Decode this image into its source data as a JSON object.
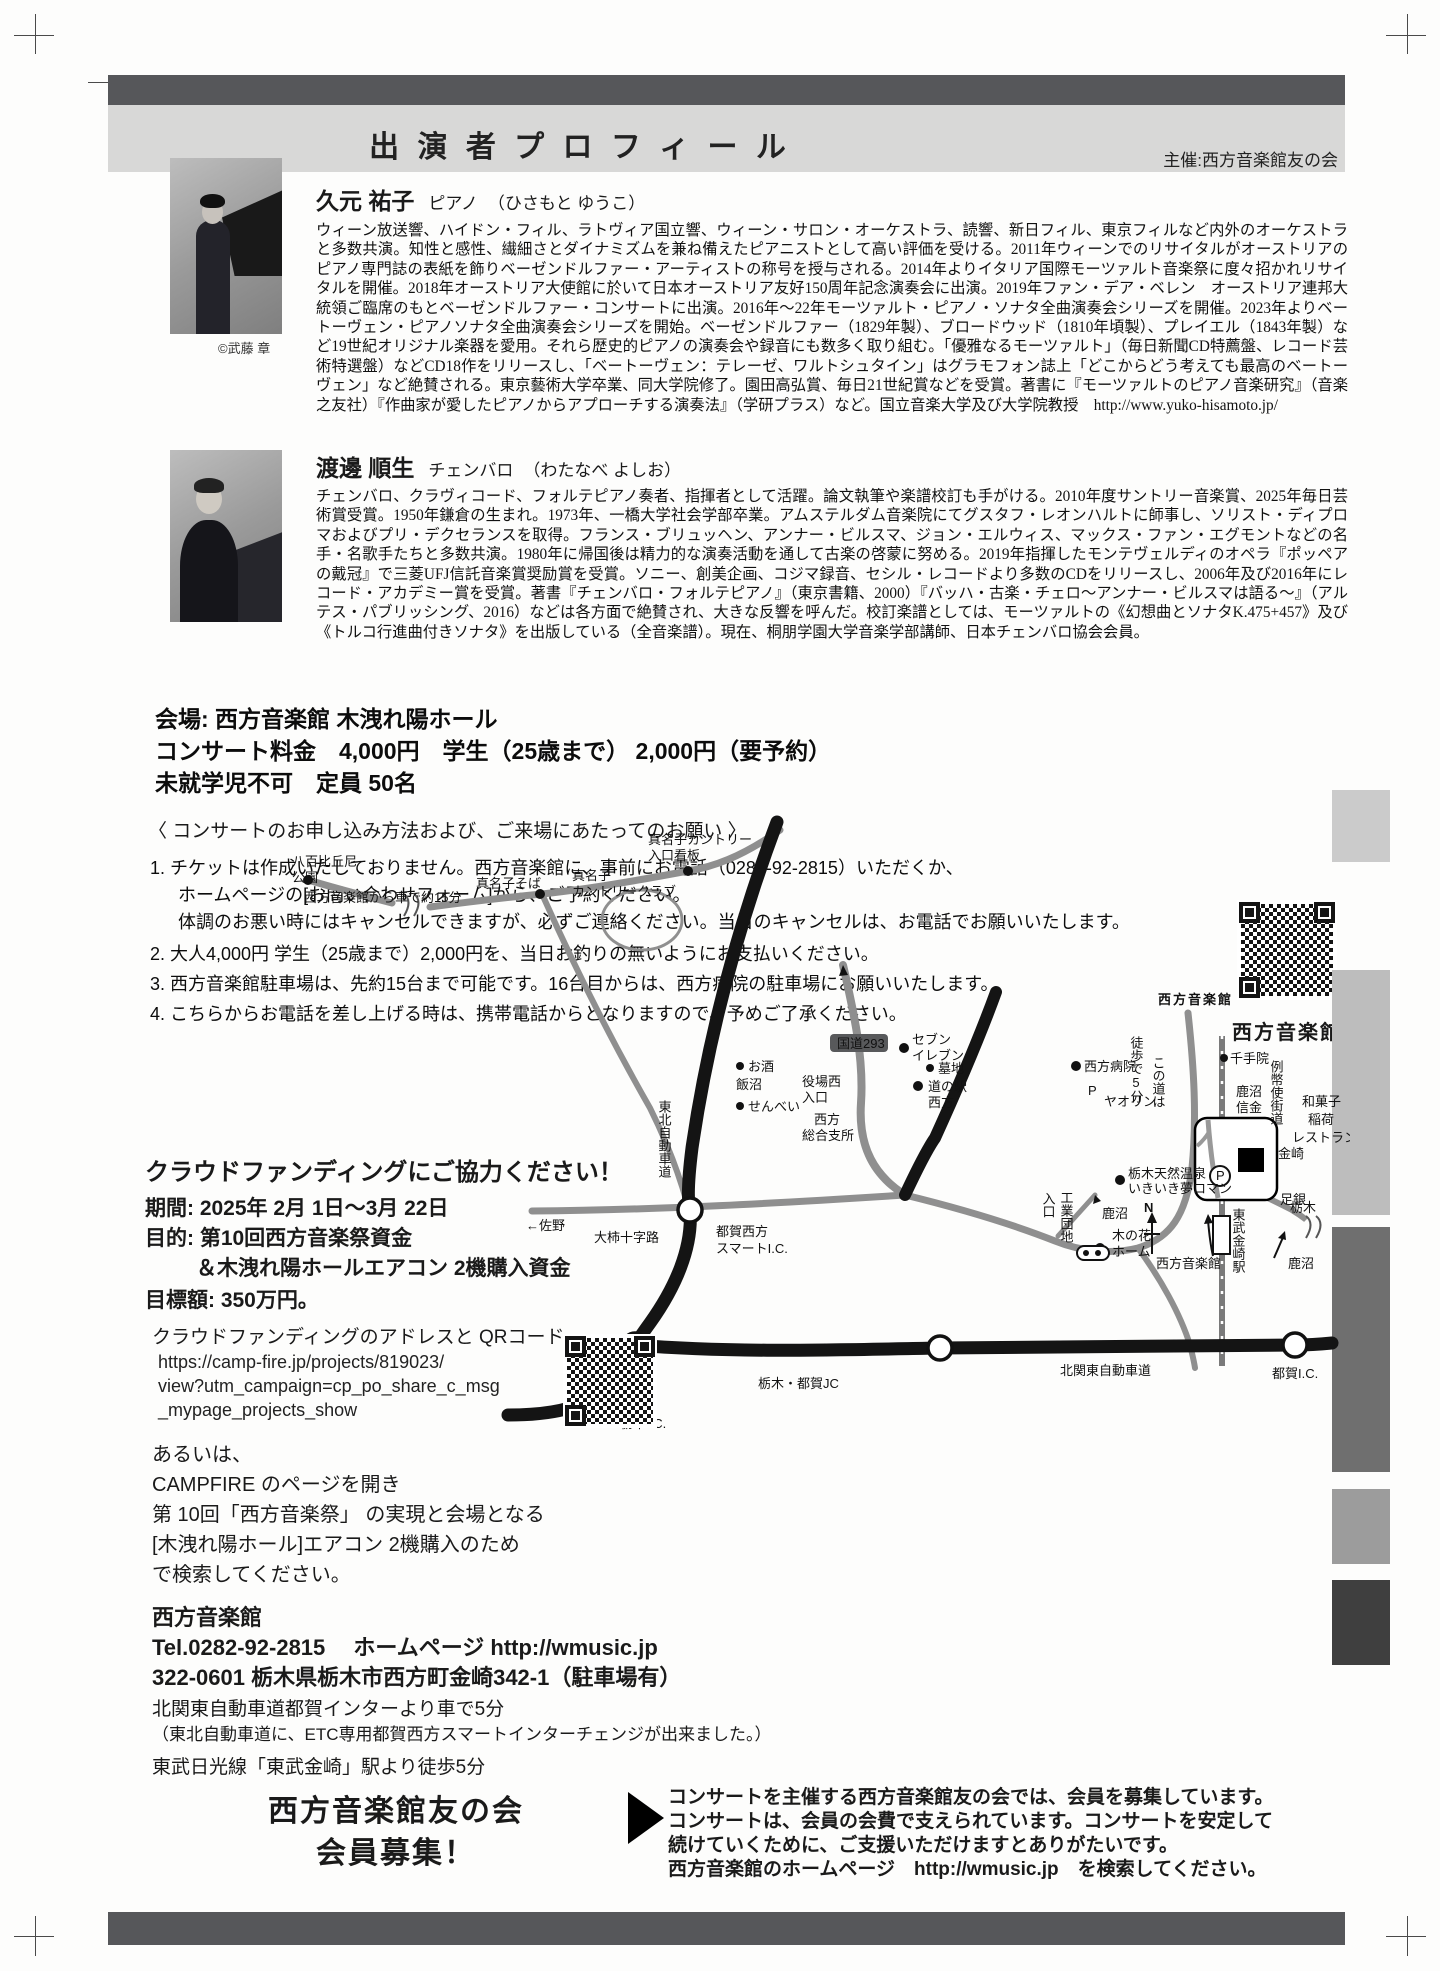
{
  "colors": {
    "header_bar": "#56575a",
    "header_panel": "#d8d8d7",
    "road_black": "#141414",
    "road_gray": "#8f8f8f"
  },
  "header": {
    "title": "出 演 者 プ ロ フ ィ ー ル",
    "organizer": "主催:西方音楽館友の会"
  },
  "performers": [
    {
      "name": "久元 祐子",
      "role": "ピアノ",
      "reading": "（ひさもと ゆうこ）",
      "photo_credit": "©武藤 章",
      "bio": "ウィーン放送響、ハイドン・フィル、ラトヴィア国立響、ウィーン・サロン・オーケストラ、読響、新日フィル、東京フィルなど内外のオーケストラと多数共演。知性と感性、繊細さとダイナミズムを兼ね備えたピアニストとして高い評価を受ける。2011年ウィーンでのリサイタルがオーストリアのピアノ専門誌の表紙を飾りベーゼンドルファー・アーティストの称号を授与される。2014年よりイタリア国際モーツァルト音楽祭に度々招かれリサイタルを開催。2018年オーストリア大使館に於いて日本オーストリア友好150周年記念演奏会に出演。2019年ファン・デア・ベレン　オーストリア連邦大統領ご臨席のもとベーゼンドルファー・コンサートに出演。2016年〜22年モーツァルト・ピアノ・ソナタ全曲演奏会シリーズを開催。2023年よりベートーヴェン・ピアノソナタ全曲演奏会シリーズを開始。ベーゼンドルファー（1829年製）、ブロードウッド（1810年頃製）、プレイエル（1843年製）など19世紀オリジナル楽器を愛用。それら歴史的ピアノの演奏会や録音にも数多く取り組む。「優雅なるモーツァルト」（毎日新聞CD特薦盤、レコード芸術特選盤）などCD18作をリリースし、「ベートーヴェン：テレーゼ、ワルトシュタイン」はグラモフォン誌上「どこからどう考えても最高のベートーヴェン」など絶賛される。東京藝術大学卒業、同大学院修了。園田高弘賞、毎日21世紀賞などを受賞。著書に『モーツァルトのピアノ音楽研究』（音楽之友社）『作曲家が愛したピアノからアプローチする演奏法』（学研プラス）など。国立音楽大学及び大学院教授　http://www.yuko-hisamoto.jp/"
    },
    {
      "name": "渡邊 順生",
      "role": "チェンバロ",
      "reading": "（わたなべ よしお）",
      "bio": "チェンバロ、クラヴィコード、フォルテピアノ奏者、指揮者として活躍。論文執筆や楽譜校訂も手がける。2010年度サントリー音楽賞、2025年毎日芸術賞受賞。1950年鎌倉の生まれ。1973年、一橋大学社会学部卒業。アムステルダム音楽院にてグスタフ・レオンハルトに師事し、ソリスト・ディプロマおよびプリ・デクセランスを取得。フランス・ブリュッヘン、アンナー・ビルスマ、ジョン・エルウィス、マックス・ファン・エグモントなどの名手・名歌手たちと多数共演。1980年に帰国後は精力的な演奏活動を通して古楽の啓蒙に努める。2019年指揮したモンテヴェルディのオペラ『ポッペアの戴冠』で三菱UFJ信託音楽賞奨励賞を受賞。ソニー、創美企画、コジマ録音、セシル・レコードより多数のCDをリリースし、2006年及び2016年にレコード・アカデミー賞を受賞。著書『チェンバロ・フォルテピアノ』（東京書籍、2000）『バッハ・古楽・チェロ〜アンナー・ビルスマは語る〜』（アルテス・パブリッシング、2016）などは各方面で絶賛され、大きな反響を呼んだ。校訂楽譜としては、モーツァルトの《幻想曲とソナタK.475+457》及び《トルコ行進曲付きソナタ》を出版している（全音楽譜）。現在、桐朋学園大学音楽学部講師、日本チェンバロ協会会員。"
    }
  ],
  "venue": {
    "line1": "会場: 西方音楽館 木洩れ陽ホール",
    "line2": "コンサート料金　4,000円　学生（25歳まで） 2,000円（要予約）",
    "line3": "未就学児不可　定員 50名"
  },
  "booking": {
    "heading": "〈 コンサートのお申し込み方法および、ご来場にあたってのお願い 〉",
    "item1_l1": "1. チケットは作成いたしておりません。西方音楽館に、事前にお電話（0282-92-2815）いただくか、",
    "item1_l2": "ホームページの[お問い合わせフォーム]から、ご予約ください。",
    "item1_l3": "体調のお悪い時にはキャンセルできますが、必ずご連絡ください。当日のキャンセルは、お電話でお願いいたします。",
    "item2": "2. 大人4,000円  学生（25歳まで）2,000円を、当日お釣りの無いようにお支払いください。",
    "item3": "3. 西方音楽館駐車場は、先約15台まで可能です。16台目からは、西方病院の駐車場にお願いいたします。",
    "item4": "4. こちらからお電話を差し上げる時は、携帯電話からとなりますので、予めご了承ください。"
  },
  "qr_hall_caption": "西方音楽館",
  "crowdfunding": {
    "title": "クラウドファンディングにご協力ください！",
    "period": "期間: 2025年 2月 1日〜3月 22日",
    "purpose1": "目的: 第10回西方音楽祭資金",
    "purpose2": "＆木洩れ陽ホールエアコン 2機購入資金",
    "goal": "目標額: 350万円。",
    "address_heading": "クラウドファンディングのアドレスと QRコード",
    "url_l1": "https://camp-fire.jp/projects/819023/",
    "url_l2": "view?utm_campaign=cp_po_share_c_msg",
    "url_l3": "_mypage_projects_show",
    "alt": "あるいは、",
    "campfire_l1": "CAMPFIRE のページを開き",
    "campfire_l2": "第 10回「西方音楽祭」 の実現と会場となる",
    "campfire_l3": "[木洩れ陽ホール]エアコン 2機購入のため",
    "campfire_l4": "で検索してください。"
  },
  "contact": {
    "name": "西方音楽館",
    "tel_line": "Tel.0282-92-2815　 ホームページ  http://wmusic.jp",
    "address": "322-0601 栃木県栃木市西方町金崎342-1（駐車場有）",
    "access1": "北関東自動車道都賀インターより車で5分",
    "access2": "（東北自動車道に、ETC専用都賀西方スマートインターチェンジが出来ました。）",
    "access3": "東武日光線「東武金崎」駅より徒歩5分"
  },
  "membership": {
    "title_l1": "西方音楽館友の会",
    "title_l2": "会員募集！",
    "body_l1": "コンサートを主催する西方音楽館友の会では、会員を募集しています。",
    "body_l2": "コンサートは、会員の会費で支えられています。コンサートを安定して",
    "body_l3": "続けていくために、ご支援いただけますとありがたいです。",
    "body_l4": "西方音楽館のホームページ　http://wmusic.jp　を検索してください。"
  },
  "map": {
    "labels": [
      "真名子カントリー",
      "入口看板",
      "八百比丘尼",
      "公園",
      "西方音楽館から車で約15分",
      "真名子そば",
      "真名子",
      "カントリークラブ",
      "鹿沼",
      "入口",
      "工業団地",
      "木の花",
      "ホーム",
      "西方音楽館",
      "セブン",
      "イレブン",
      "国道293",
      "墓地",
      "西方病院",
      "P",
      "ヤオリン",
      "徒歩で5分",
      "この道は",
      "お酒",
      "飯沼",
      "せんべい",
      "役場西",
      "入口",
      "道の駅",
      "西方",
      "西方",
      "総合支所",
      "千手院",
      "鹿沼",
      "信金",
      "例幣使街道",
      "金崎",
      "和菓子",
      "稲荷",
      "レストラン",
      "足銀",
      "東武金崎駅",
      "栃木天然温泉",
      "いきいき夢ロマン",
      "栃木",
      "←佐野",
      "大柿十字路",
      "都賀西方",
      "スマートI.C.",
      "東北自動車道",
      "栃木・都賀JC",
      "北関東自動車道",
      "都賀I.C.",
      "栃木I.C.",
      "西方音楽館",
      "鹿沼",
      "N",
      "P"
    ]
  }
}
